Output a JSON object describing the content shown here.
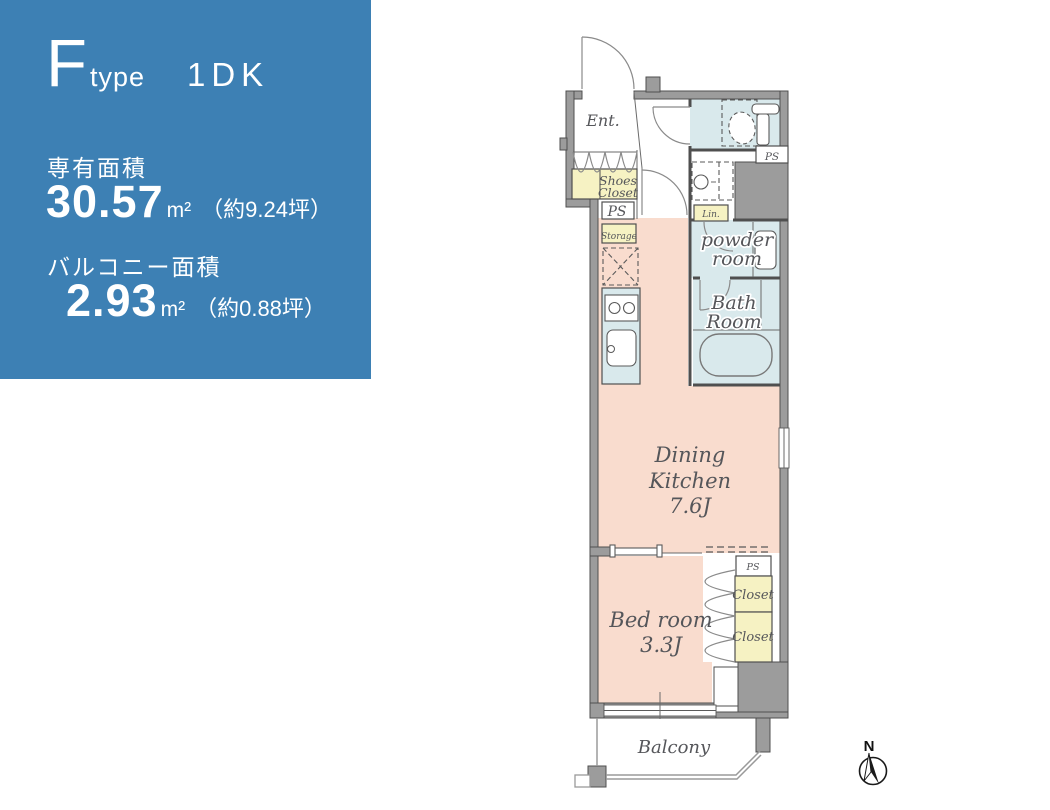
{
  "panel": {
    "type_letter": "F",
    "type_word": "type",
    "layout": "1DK",
    "own_area_label": "専有面積",
    "own_area_value": "30.57",
    "own_area_unit": "m²",
    "own_area_note": "（約9.24坪）",
    "balcony_area_label": "バルコニー面積",
    "balcony_area_value": "2.93",
    "balcony_area_unit": "m²",
    "balcony_area_note": "（約0.88坪）"
  },
  "floorplan": {
    "labels": {
      "ent": "Ent.",
      "shoes1": "Shoes",
      "shoes2": "Closet",
      "ps_hall": "PS",
      "storage": "Storage",
      "lin": "Lin.",
      "ps_toilet": "PS",
      "powder1": "powder",
      "powder2": "room",
      "bath1": "Bath",
      "bath2": "Room",
      "dk1": "Dining",
      "dk2": "Kitchen",
      "dk3": "7.6J",
      "bed1": "Bed room",
      "bed2": "3.3J",
      "ps_bed": "PS",
      "closet_upper": "Closet",
      "closet_lower": "Closet",
      "balcony": "Balcony"
    },
    "compass_label": "N",
    "colors": {
      "panel_bg": "#3d80b4",
      "room_pink": "#f9dcce",
      "wet_blue": "#d9e9ec",
      "closet_yellow": "#f6f2c3",
      "wall_gray": "#9c9c9c",
      "wall_outline": "#4f4f4f",
      "label_gray": "#55565a",
      "panel_text": "#ffffff"
    }
  }
}
